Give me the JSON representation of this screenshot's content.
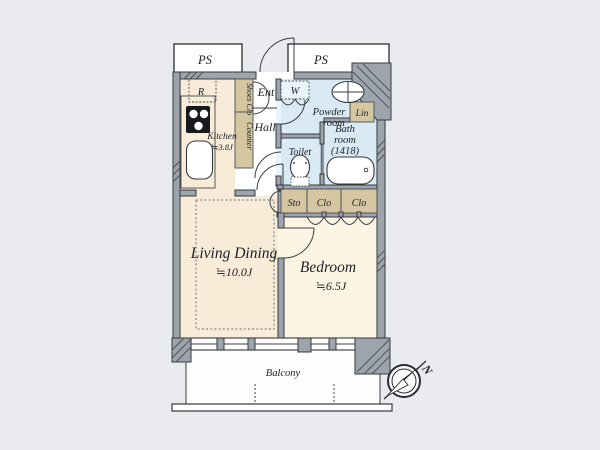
{
  "floorplan": {
    "ps_left": "PS",
    "ps_right": "PS",
    "rooms": {
      "kitchen_name": "Kitchen",
      "kitchen_size": "≒3.8J",
      "living_name": "Living Dining",
      "living_size": "≒10.0J",
      "bedroom_name": "Bedroom",
      "bedroom_size": "≒6.5J",
      "entrance": "Ent",
      "hall": "Hall",
      "washer": "W",
      "powder_line1": "Powder",
      "powder_line2": "room",
      "bath_line1": "Bath",
      "bath_line2": "room",
      "bath_line3": "(1418)",
      "toilet": "Toilet",
      "linen": "Lin",
      "refrigerator": "R",
      "shoes_closet": "Shoes Clo",
      "counter": "Counter",
      "storage": "Sto",
      "closet1": "Clo",
      "closet2": "Clo",
      "balcony": "Balcony"
    },
    "compass": {
      "north_label": "N"
    },
    "fixtures": [
      "stove-icon",
      "kitchen-sink-icon",
      "lavatory-sink-icon",
      "toilet-icon",
      "bathtub-icon",
      "compass-icon"
    ],
    "colors": {
      "background": "#e9ebee",
      "wall": "#9ea4ac",
      "wall_outline": "#35393f",
      "floor_cream": "#f8ecd9",
      "floor_bedroom": "#fcf5e3",
      "wet_area_blue": "#d9eaf5",
      "closet_tan": "#d3c6a1",
      "white": "#ffffff",
      "text": "#1d2024"
    }
  }
}
